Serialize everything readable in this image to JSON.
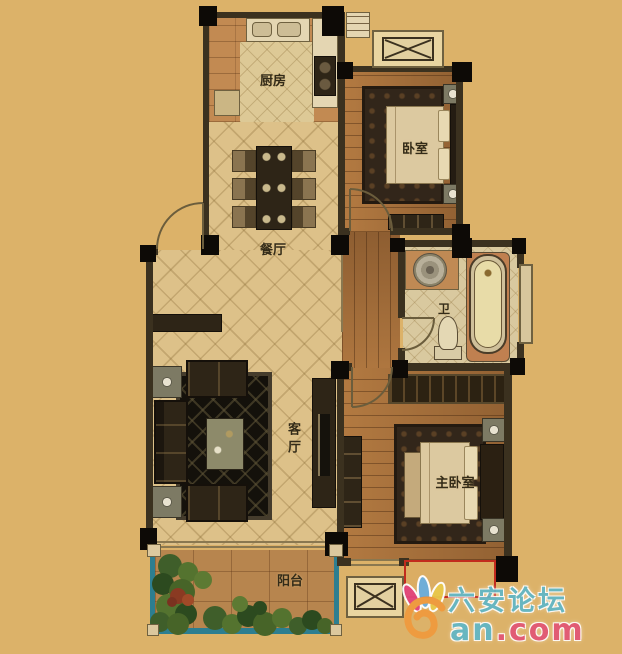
{
  "rooms": {
    "kitchen": {
      "label": "厨房"
    },
    "bedroom": {
      "label": "卧室"
    },
    "dining": {
      "label": "餐厅"
    },
    "bathroom": {
      "label": "卫"
    },
    "living": {
      "label": "客厅"
    },
    "master_bedroom": {
      "label": "主卧室"
    },
    "balcony": {
      "label": "阳台"
    }
  },
  "watermark": {
    "site_name": "六安论坛",
    "domain_teal": "an",
    "domain_pink": ".com"
  },
  "colors": {
    "background": "#dcb269",
    "wall": "#3b311f",
    "corner_post": "#0d0a06",
    "diamond_tile": "#ddc189",
    "wood_floor": "#aa713b",
    "balcony_tile": "#b7854e",
    "balcony_railing": "#2d7e90",
    "highlight_red": "#c22b1e",
    "watermark_teal": "#5fb7c8",
    "watermark_pink": "#e25576",
    "watermark_orange": "#ef9a3e"
  }
}
